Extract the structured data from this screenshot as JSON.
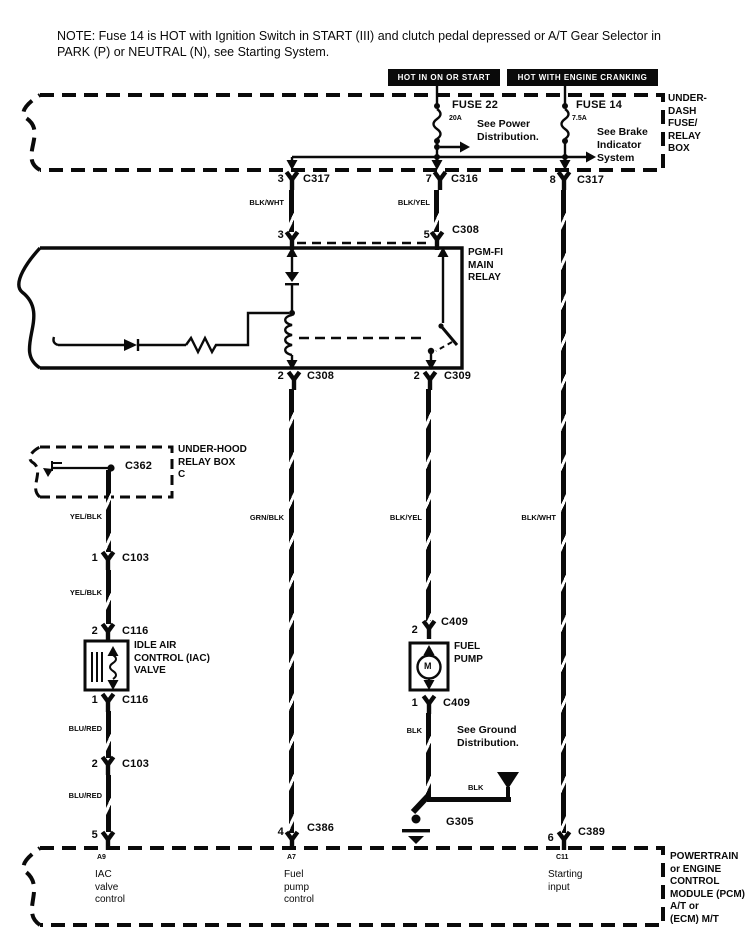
{
  "note": "NOTE: Fuse 14 is HOT with Ignition Switch in START (III) and clutch pedal depressed or A/T Gear Selector in PARK (P) or NEUTRAL (N), see Starting System.",
  "banners": {
    "left": "HOT IN ON OR START",
    "right": "HOT WITH ENGINE CRANKING"
  },
  "underdash_box": {
    "label": "UNDER-\nDASH\nFUSE/\nRELAY\nBOX",
    "fuse22": {
      "name": "FUSE 22",
      "rating": "20A",
      "see": "See Power\nDistribution."
    },
    "fuse14": {
      "name": "FUSE 14",
      "rating": "7.5A",
      "see": "See Brake\nIndicator\nSystem"
    }
  },
  "connector_row": {
    "left": {
      "pin": "3",
      "name": "C317"
    },
    "middle": {
      "pin": "7",
      "name": "C316"
    },
    "right": {
      "pin": "8",
      "name": "C317"
    }
  },
  "wires": {
    "blk_wht_top": "BLK/WHT",
    "blk_yel_top": "BLK/YEL",
    "grn_blk": "GRN/BLK",
    "blk_yel_mid": "BLK/YEL",
    "blk_wht_long": "BLK/WHT",
    "yel_blk_1": "YEL/BLK",
    "yel_blk_2": "YEL/BLK",
    "blu_red_1": "BLU/RED",
    "blu_red_2": "BLU/RED",
    "blk_1": "BLK",
    "blk_2": "BLK"
  },
  "relay": {
    "label": "PGM-FI\nMAIN\nRELAY",
    "top_pin_left": "3",
    "top_pin_right": "5",
    "top_connector": "C308",
    "bottom_left": {
      "pin": "2",
      "name": "C308"
    },
    "bottom_right": {
      "pin": "2",
      "name": "C309"
    }
  },
  "underhood_box": {
    "label": "UNDER-HOOD\nRELAY BOX\nC",
    "connector": "C362"
  },
  "left_branch": {
    "c103_upper": {
      "pin": "1",
      "name": "C103"
    },
    "c116_upper": {
      "pin": "2",
      "name": "C116"
    },
    "iac_label": "IDLE AIR\nCONTROL (IAC)\nVALVE",
    "c116_lower": {
      "pin": "1",
      "name": "C116"
    },
    "c103_lower": {
      "pin": "2",
      "name": "C103"
    },
    "pcm_pin": "5"
  },
  "fuel_branch": {
    "c409_upper": {
      "pin": "2",
      "name": "C409"
    },
    "pump_label": "FUEL\nPUMP",
    "motor": "M",
    "c409_lower": {
      "pin": "1",
      "name": "C409"
    },
    "see_ground": "See Ground\nDistribution.",
    "ground_name": "G305",
    "pcm_pin": "4",
    "pcm_connector": "C386"
  },
  "right_branch": {
    "pcm_pin": "6",
    "pcm_connector": "C389"
  },
  "pcm_box": {
    "label": "POWERTRAIN\nor ENGINE\nCONTROL\nMODULE (PCM)\nA/T or\n(ECM) M/T",
    "pins": [
      {
        "id": "A9",
        "desc": "IAC\nvalve\ncontrol"
      },
      {
        "id": "A7",
        "desc": "Fuel\npump\ncontrol"
      },
      {
        "id": "C11",
        "desc": "Starting\ninput"
      }
    ]
  }
}
